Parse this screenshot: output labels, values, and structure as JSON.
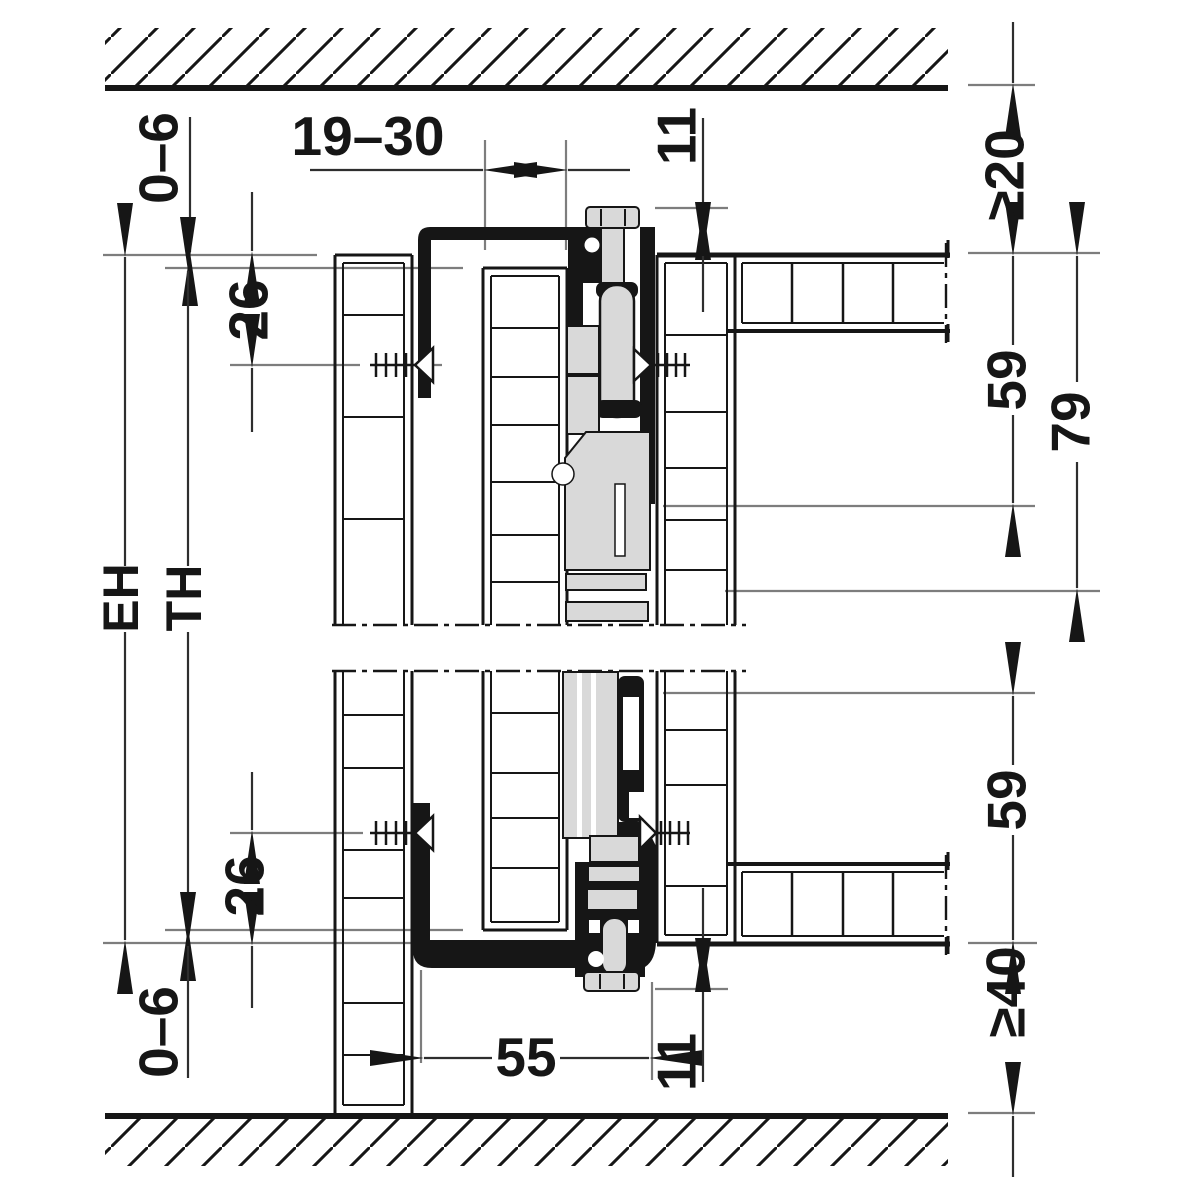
{
  "drawing": {
    "type": "technical-section-diagram",
    "description": "Vertical cross-section of a slide-in / pocket door fitting between ceiling and floor with cabinet panels, running gear and dimension chains",
    "colors": {
      "line": "#161616",
      "reference": "#7d7d7d",
      "metal_fill": "#d9d9d9",
      "background": "#ffffff"
    },
    "dims": {
      "gap_top": "0–6",
      "door_thickness": "19–30",
      "clearance_fitting_top": "11",
      "ceiling_clearance": "≥20",
      "screw_offset_top": "26",
      "installation_height": "EH",
      "door_height": "TH",
      "track_length_top": "59",
      "fitting_depth_top": "79",
      "screw_offset_bottom": "26",
      "gap_bottom": "0–6",
      "track_distance": "55",
      "clearance_fitting_bottom": "11",
      "track_length_bottom": "59",
      "floor_clearance": "≥40"
    }
  }
}
